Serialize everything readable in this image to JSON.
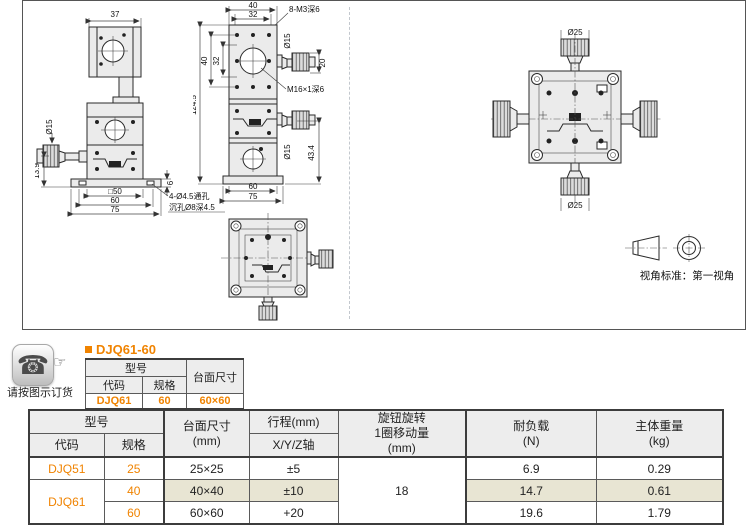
{
  "colors": {
    "accent": "#f08300",
    "row_highlight": "#e8e5d3",
    "table_header_bg": "#ededed"
  },
  "icons": {
    "phone": "☎",
    "hand": "☞"
  },
  "order": {
    "note": "请按图示订货"
  },
  "product": {
    "title": "DJQ61-60"
  },
  "drawings": {
    "view_standard": "视角标准：第一视角",
    "side": {
      "d37": "37",
      "dphi15": "Ø15",
      "d139": "13.9",
      "d50": "□50",
      "d60": "60",
      "d75": "75",
      "d6": "6",
      "note1": "4-Ø4.5通孔",
      "note2": "沉孔Ø8深4.5"
    },
    "front": {
      "d40t": "40",
      "d32t": "32",
      "tap8": "8-M3深6",
      "dphi15t": "Ø15",
      "d20": "20",
      "d40l": "40",
      "d32l": "32",
      "d1245": "124.5",
      "tapm16": "M16×1深6",
      "dphi15m": "Ø15",
      "d434": "43.4",
      "d60": "60",
      "d75": "75"
    },
    "top": {
      "dphi25t": "Ø25",
      "dphi25b": "Ø25"
    }
  },
  "mini_table": {
    "model": "型号",
    "code": "代码",
    "spec": "规格",
    "size": "台面尺寸",
    "row": {
      "code": "DJQ61",
      "spec": "60",
      "size": "60×60"
    }
  },
  "spec_table": {
    "headers": {
      "model": "型号",
      "code": "代码",
      "spec": "规格",
      "size": "台面尺寸\n(mm)",
      "travel": "行程(mm)",
      "travel_axis": "X/Y/Z轴",
      "knob": "旋钮旋转\n1圈移动量\n(mm)",
      "load": "耐负载\n(N)",
      "weight": "主体重量\n(kg)"
    },
    "knob_value": "18",
    "rows": [
      {
        "code": "DJQ51",
        "spec": "25",
        "size": "25×25",
        "travel": "±5",
        "load": "6.9",
        "weight": "0.29"
      },
      {
        "code": "DJQ61",
        "spec": "40",
        "size": "40×40",
        "travel": "±10",
        "load": "14.7",
        "weight": "0.61"
      },
      {
        "code": "",
        "spec": "60",
        "size": "60×60",
        "travel": "+20",
        "load": "19.6",
        "weight": "1.79"
      }
    ]
  }
}
